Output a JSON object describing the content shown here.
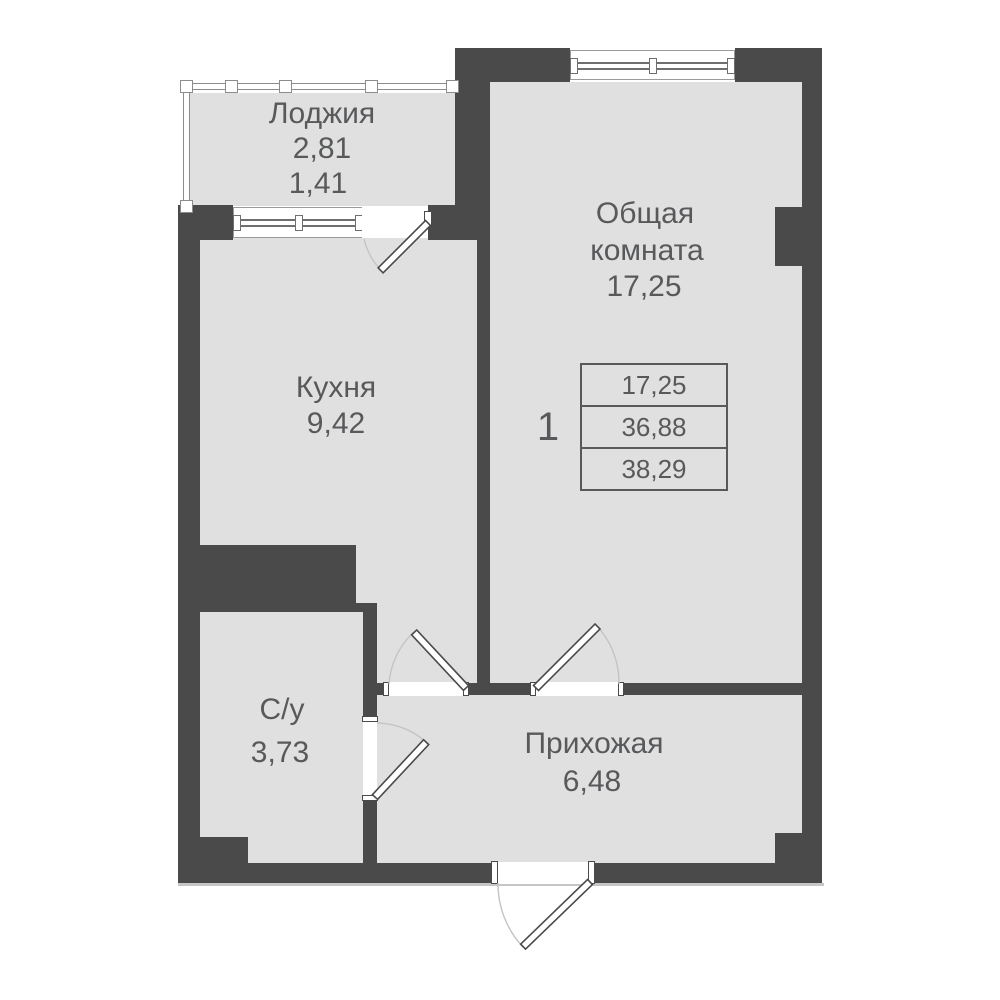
{
  "colors": {
    "wall": "#4a4a4b",
    "floor": "#e0e0e0",
    "text": "#58595b",
    "line": "#6f6f72",
    "rail": "#8c8c8c",
    "arc": "#c4c4c4"
  },
  "rooms": {
    "loggia": {
      "name": "Лоджия",
      "area": "2,81",
      "area_secondary": "1,41"
    },
    "kitchen": {
      "name": "Кухня",
      "area": "9,42"
    },
    "living_room": {
      "name_line1": "Общая",
      "name_line2": "комната",
      "area": "17,25"
    },
    "bathroom": {
      "name": "С/у",
      "area": "3,73"
    },
    "hallway": {
      "name": "Прихожая",
      "area": "6,48"
    }
  },
  "apartment_summary": {
    "unit_number": "1",
    "living_area": "17,25",
    "floor_area": "36,88",
    "total_area": "38,29"
  }
}
